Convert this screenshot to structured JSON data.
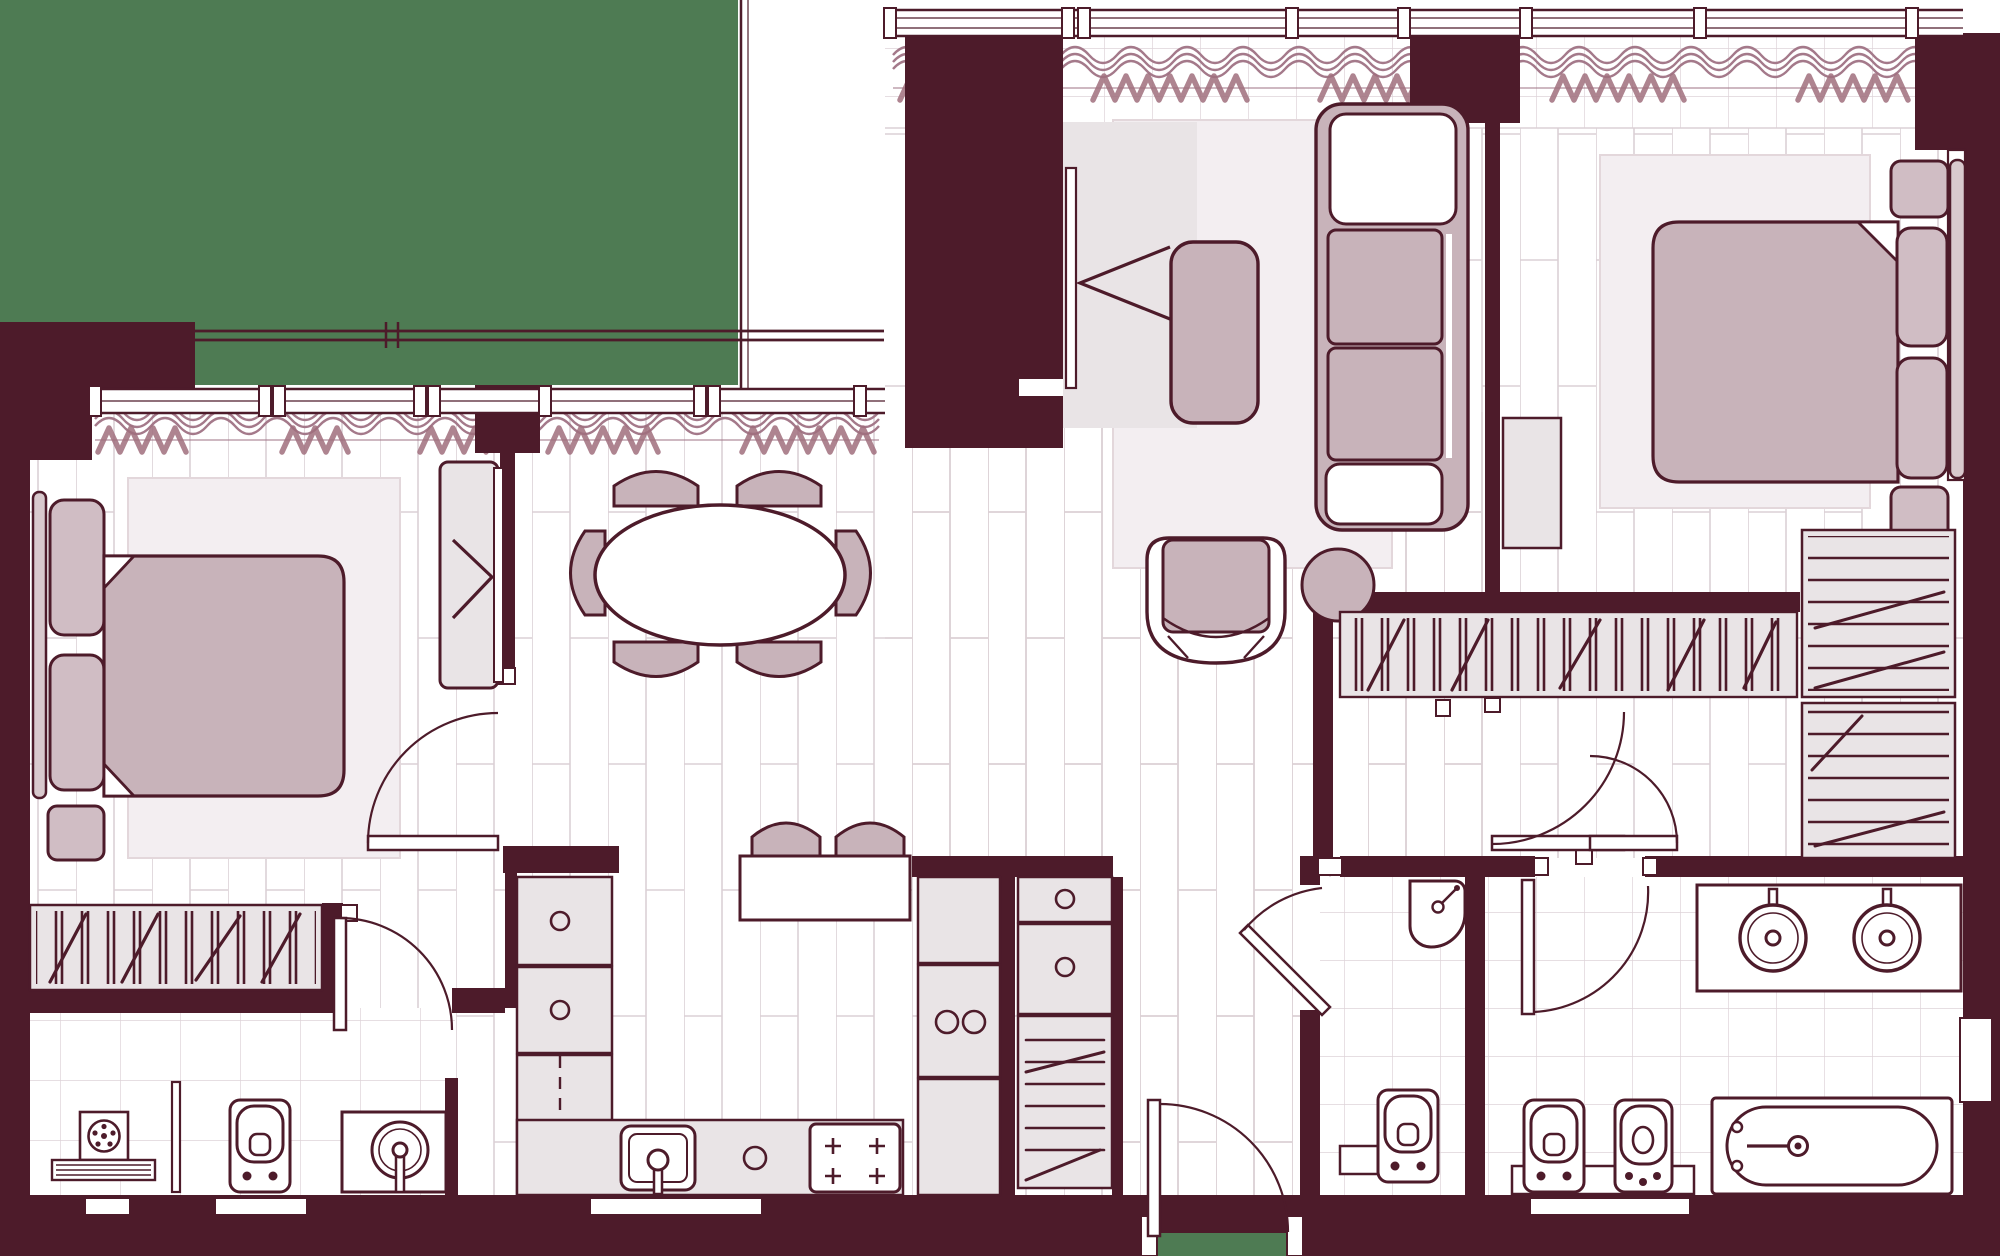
{
  "canvas": {
    "width": 2000,
    "height": 1256
  },
  "colors": {
    "outside_green": "#4e7b53",
    "wall": "#4d1b2a",
    "fixture_white": "#ffffff",
    "plank_line": "#dbd0d5",
    "tile_line": "#ded3d8",
    "rug": "#f3eef1",
    "furniture_mauve": "#c8b3ba",
    "furniture_mauve_light": "#d0bdc4",
    "headboard": "#d8c9cd",
    "cabinet_gray": "#e9e4e6",
    "curtain_wave": "#a4798a",
    "curtain_zigzag": "#a06e7d"
  },
  "floorplan": {
    "type": "apartment-top-view",
    "rooms": [
      {
        "name": "bedroom-left",
        "furniture": [
          "double-bed",
          "two-pillows",
          "headboard",
          "nightstand",
          "sliding-wardrobe",
          "rug",
          "hanging-closet"
        ]
      },
      {
        "name": "dining-area",
        "furniture": [
          "oval-table",
          "six-chairs"
        ]
      },
      {
        "name": "kitchen",
        "furniture": [
          "island-counter",
          "two-bar-stools",
          "sink",
          "cooktop-4-burners",
          "cabinet-column",
          "fridge-column",
          "shoe-cabinet"
        ]
      },
      {
        "name": "living-room",
        "furniture": [
          "sofa",
          "armchair",
          "coffee-table",
          "round-ottoman",
          "tv-wall-unit",
          "rug"
        ]
      },
      {
        "name": "bedroom-right",
        "furniture": [
          "double-bed",
          "two-pillows",
          "headboard",
          "two-nightstands",
          "dresser",
          "rug"
        ]
      },
      {
        "name": "dressing-room",
        "furniture": [
          "hanging-rail-closet",
          "shelf-rack",
          "shoe-rack"
        ]
      },
      {
        "name": "bathroom-left",
        "furniture": [
          "washing-machine",
          "toilet",
          "vanity-sink",
          "bath-mat",
          "glass-partition"
        ]
      },
      {
        "name": "wc-shower",
        "furniture": [
          "corner-shower",
          "toilet",
          "shelf"
        ]
      },
      {
        "name": "bathroom-master",
        "furniture": [
          "double-vanity",
          "toilet",
          "bidet",
          "bathtub"
        ]
      },
      {
        "name": "hallway-entrance",
        "furniture": [
          "entrance-door"
        ]
      }
    ],
    "door_count": 7,
    "window_sides": [
      "top",
      "left-wing-top",
      "right",
      "bottom-sills"
    ],
    "outside": "green-surround-with-balcony-rail"
  }
}
